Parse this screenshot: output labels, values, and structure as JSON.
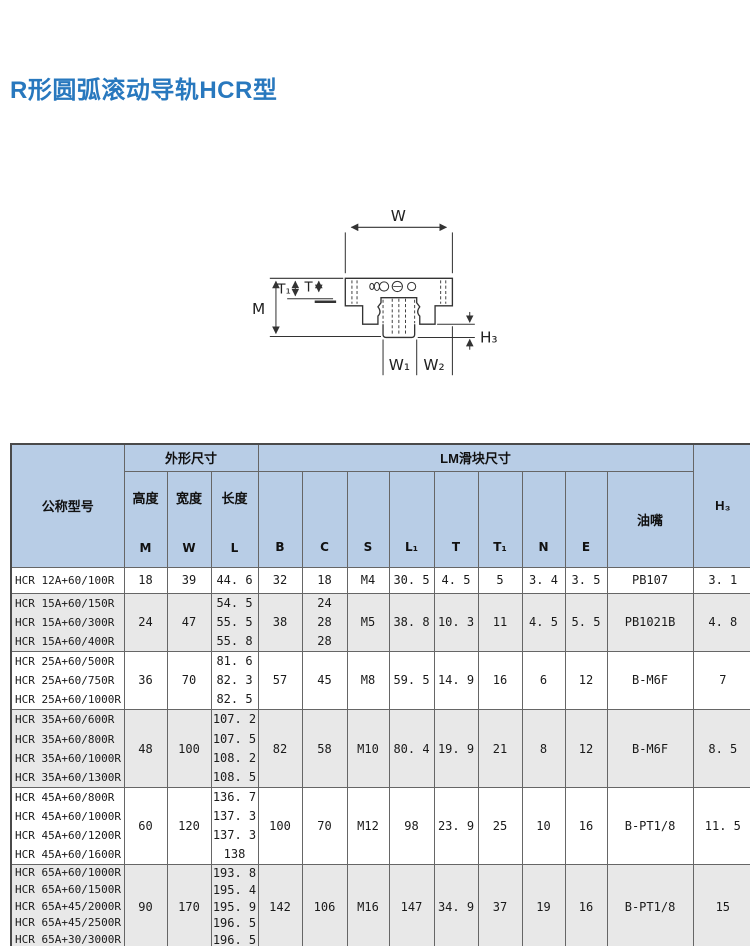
{
  "page": {
    "title": "R形圆弧滚动导轨HCR型"
  },
  "colors": {
    "title_blue": "#2878be",
    "header_bg": "#b8cde6",
    "shaded_row": "#e8e8e8",
    "grid_line": "#666666"
  },
  "diagram": {
    "labels": {
      "W": "W",
      "T1": "T₁",
      "T": "T",
      "M": "M",
      "H3": "H₃",
      "W1": "W₁",
      "W2": "W₂"
    }
  },
  "table": {
    "header": {
      "model": "公称型号",
      "outer_group": "外形尺寸",
      "block_group": "LM滑块尺寸",
      "height_label": "高度",
      "height_sym": "M",
      "width_label": "宽度",
      "width_sym": "W",
      "length_label": "长度",
      "length_sym": "L",
      "cols": [
        "B",
        "C",
        "S",
        "L₁",
        "T",
        "T₁",
        "N",
        "E"
      ],
      "nipple": "油嘴",
      "h3": "H₃"
    },
    "groups": [
      {
        "rows": [
          "HCR 12A+60/100R"
        ],
        "M": "18",
        "W": "39",
        "L": [
          "44. 6"
        ],
        "B": "32",
        "C": [
          "18"
        ],
        "S": "M4",
        "L1": "30. 5",
        "T": "4. 5",
        "T1": "5",
        "N": "3. 4",
        "E": "3. 5",
        "nipple": "PB107",
        "H3": "3. 1",
        "height": 25,
        "shaded": false
      },
      {
        "rows": [
          "HCR 15A+60/150R",
          "HCR 15A+60/300R",
          "HCR 15A+60/400R"
        ],
        "M": "24",
        "W": "47",
        "L": [
          "54. 5",
          "55. 5",
          "55. 8"
        ],
        "B": "38",
        "C": [
          "24",
          "28",
          "28"
        ],
        "S": "M5",
        "L1": "38. 8",
        "T": "10. 3",
        "T1": "11",
        "N": "4. 5",
        "E": "5. 5",
        "nipple": "PB1021B",
        "H3": "4. 8",
        "height": 57,
        "shaded": true
      },
      {
        "rows": [
          "HCR 25A+60/500R",
          "HCR 25A+60/750R",
          "HCR 25A+60/1000R"
        ],
        "M": "36",
        "W": "70",
        "L": [
          "81. 6",
          "82. 3",
          "82. 5"
        ],
        "B": "57",
        "C": [
          "45"
        ],
        "S": "M8",
        "L1": "59. 5",
        "T": "14. 9",
        "T1": "16",
        "N": "6",
        "E": "12",
        "nipple": "B-M6F",
        "H3": "7",
        "height": 58,
        "shaded": false
      },
      {
        "rows": [
          "HCR 35A+60/600R",
          "HCR 35A+60/800R",
          "HCR 35A+60/1000R",
          "HCR 35A+60/1300R"
        ],
        "M": "48",
        "W": "100",
        "L": [
          "107. 2",
          "107. 5",
          "108. 2",
          "108. 5"
        ],
        "B": "82",
        "C": [
          "58"
        ],
        "S": "M10",
        "L1": "80. 4",
        "T": "19. 9",
        "T1": "21",
        "N": "8",
        "E": "12",
        "nipple": "B-M6F",
        "H3": "8. 5",
        "height": 77,
        "shaded": true
      },
      {
        "rows": [
          "HCR 45A+60/800R",
          "HCR 45A+60/1000R",
          "HCR 45A+60/1200R",
          "HCR 45A+60/1600R"
        ],
        "M": "60",
        "W": "120",
        "L": [
          "136. 7",
          "137. 3",
          "137. 3",
          "138"
        ],
        "B": "100",
        "C": [
          "70"
        ],
        "S": "M12",
        "L1": "98",
        "T": "23. 9",
        "T1": "25",
        "N": "10",
        "E": "16",
        "nipple": "B-PT1/8",
        "H3": "11. 5",
        "height": 76,
        "shaded": false
      },
      {
        "rows": [
          "HCR 65A+60/1000R",
          "HCR 65A+60/1500R",
          "HCR 65A+45/2000R",
          "HCR 65A+45/2500R",
          "HCR 65A+30/3000R"
        ],
        "M": "90",
        "W": "170",
        "L": [
          "193. 8",
          "195. 4",
          "195. 9",
          "196. 5",
          "196. 5"
        ],
        "B": "142",
        "C": [
          "106"
        ],
        "S": "M16",
        "L1": "147",
        "T": "34. 9",
        "T1": "37",
        "N": "19",
        "E": "16",
        "nipple": "B-PT1/8",
        "H3": "15",
        "height": 83,
        "shaded": true
      }
    ]
  }
}
